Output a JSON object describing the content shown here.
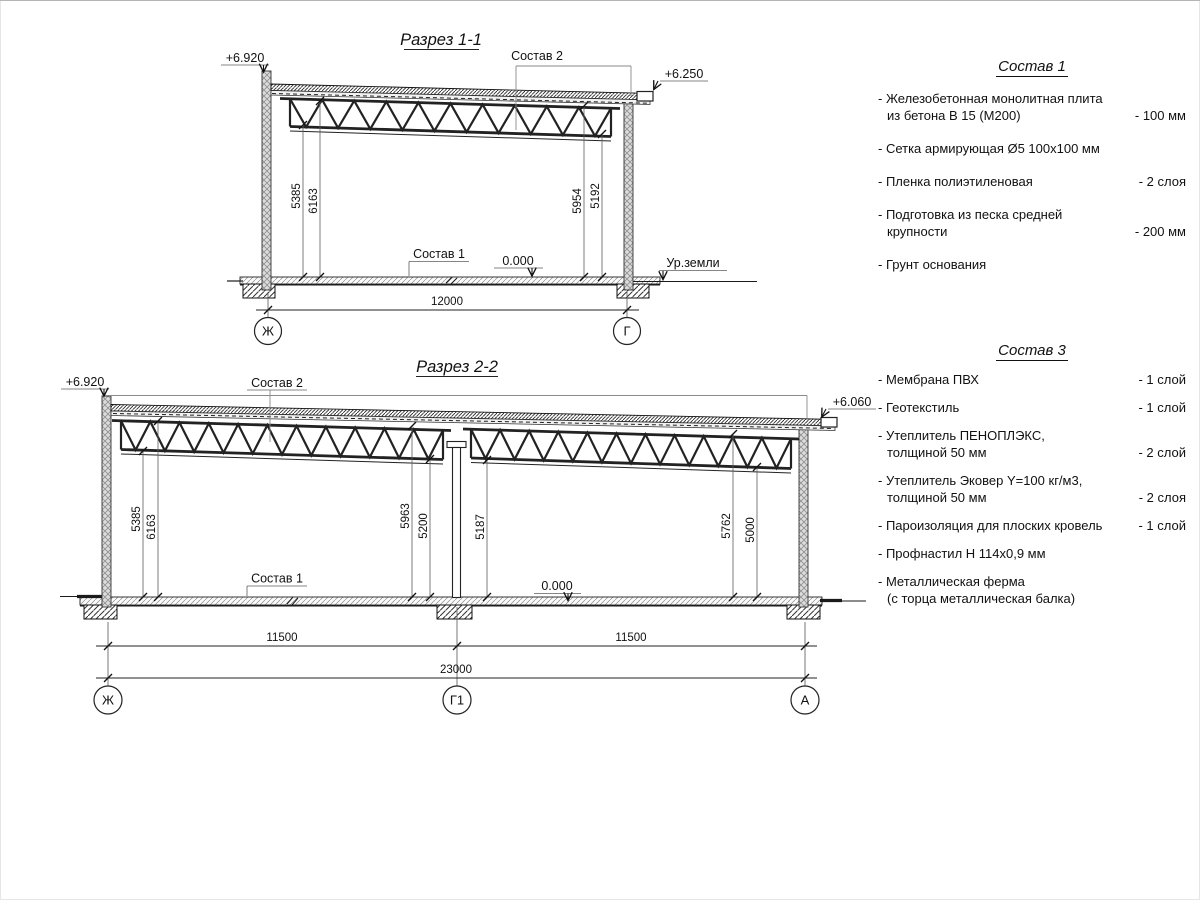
{
  "d1": {
    "title": "Разрез 1-1",
    "elev_left": "+6.920",
    "elev_right": "+6.250",
    "callout_roof": "Состав 2",
    "callout_floor": "Состав 1",
    "zero": "0.000",
    "ground": "Ур.земли",
    "dim_l1": "5385",
    "dim_l2": "6163",
    "dim_r1": "5954",
    "dim_r2": "5192",
    "span": "12000",
    "axis_left": "Ж",
    "axis_right": "Г"
  },
  "d2": {
    "title": "Разрез 2-2",
    "elev_left": "+6.920",
    "elev_right": "+6.060",
    "callout_roof": "Состав 2",
    "callout_floor": "Состав 1",
    "zero": "0.000",
    "b1_l1": "5385",
    "b1_l2": "6163",
    "b1_r1": "5963",
    "b1_r2": "5200",
    "b2_l": "5187",
    "b2_r1": "5762",
    "b2_r2": "5000",
    "span1": "11500",
    "span2": "11500",
    "total": "23000",
    "axis_left": "Ж",
    "axis_mid": "Г1",
    "axis_right": "А"
  },
  "legend1": {
    "title": "Состав 1",
    "items": [
      {
        "lines": [
          "- Железобетонная  монолитная плита",
          "из бетона В 15 (М200)"
        ],
        "value": "- 100 мм"
      },
      {
        "lines": [
          "- Сетка армирующая Ø5 100x100 мм"
        ],
        "value": ""
      },
      {
        "lines": [
          "- Пленка полиэтиленовая"
        ],
        "value": "-  2 слоя"
      },
      {
        "lines": [
          "- Подготовка из песка средней",
          "крупности"
        ],
        "value": "- 200 мм"
      },
      {
        "lines": [
          "- Грунт основания"
        ],
        "value": ""
      }
    ]
  },
  "legend3": {
    "title": "Состав 3",
    "items": [
      {
        "lines": [
          "- Мембрана ПВХ"
        ],
        "value": "- 1 слой"
      },
      {
        "lines": [
          "- Геотекстиль"
        ],
        "value": "- 1 слой"
      },
      {
        "lines": [
          "- Утеплитель ПЕНОПЛЭКС,",
          "толщиной 50 мм"
        ],
        "value": "- 2 слой"
      },
      {
        "lines": [
          "- Утеплитель Эковер Y=100 кг/м3,",
          "толщиной 50 мм"
        ],
        "value": "- 2 слоя"
      },
      {
        "lines": [
          "- Пароизоляция для плоских кровель"
        ],
        "value": "- 1 слой"
      },
      {
        "lines": [
          "- Профнастил Н 114х0,9 мм"
        ],
        "value": ""
      },
      {
        "lines": [
          "- Металлическая ферма",
          "(с торца металлическая балка)"
        ],
        "value": ""
      }
    ]
  }
}
